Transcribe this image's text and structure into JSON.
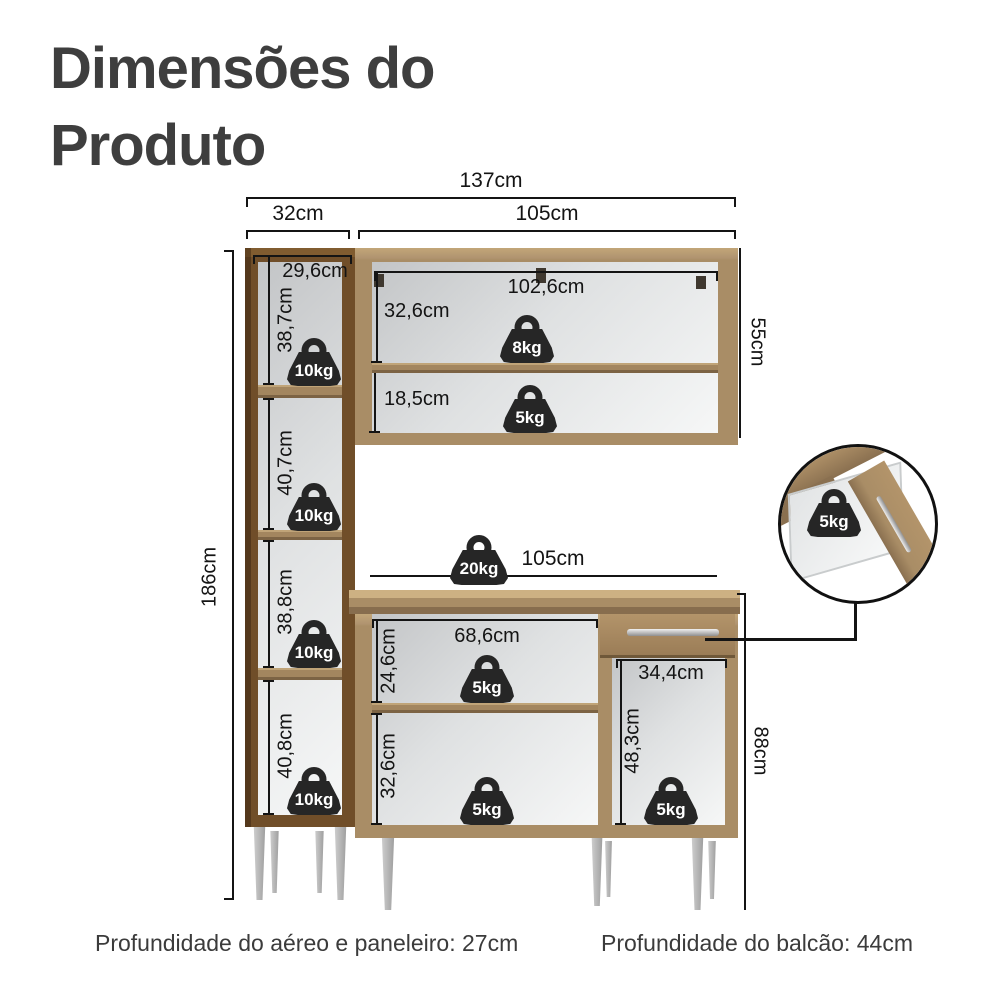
{
  "title": {
    "line1": "Dimensões do",
    "line2": "Produto"
  },
  "overall": {
    "total_width": "137cm",
    "left_unit_width": "32cm",
    "upper_cabinet_width": "105cm",
    "left_unit_height": "186cm",
    "upper_cabinet_height": "55cm",
    "lower_cabinet_height": "88cm"
  },
  "left_unit": {
    "interior_width": "29,6cm",
    "sections": [
      {
        "height": "38,7cm",
        "capacity": "10kg"
      },
      {
        "height": "40,7cm",
        "capacity": "10kg"
      },
      {
        "height": "38,8cm",
        "capacity": "10kg"
      },
      {
        "height": "40,8cm",
        "capacity": "10kg"
      }
    ]
  },
  "upper_cabinet": {
    "interior_width": "102,6cm",
    "sections": [
      {
        "height": "32,6cm",
        "capacity": "8kg"
      },
      {
        "height": "18,5cm",
        "capacity": "5kg"
      }
    ]
  },
  "countertop": {
    "width": "105cm",
    "capacity": "20kg"
  },
  "lower_cabinet": {
    "open_section": {
      "width": "68,6cm",
      "sections": [
        {
          "height": "24,6cm",
          "capacity": "5kg"
        },
        {
          "height": "32,6cm",
          "capacity": "5kg"
        }
      ]
    },
    "drawer_section": {
      "width": "34,4cm",
      "height": "48,3cm",
      "capacity": "5kg"
    },
    "drawer_detail": {
      "capacity": "5kg"
    }
  },
  "footnotes": {
    "aereo_paneleiro": "Profundidade do aéreo e paneleiro: 27cm",
    "balcao": "Profundidade do balcão: 44cm"
  },
  "colors": {
    "wood": "#a98d66",
    "wood_dark": "#7e6546",
    "wood_light": "#c2a678",
    "line": "#141414",
    "badge": "#262626",
    "leg": "#b5b5b5",
    "title_text": "#3e3e3e"
  }
}
